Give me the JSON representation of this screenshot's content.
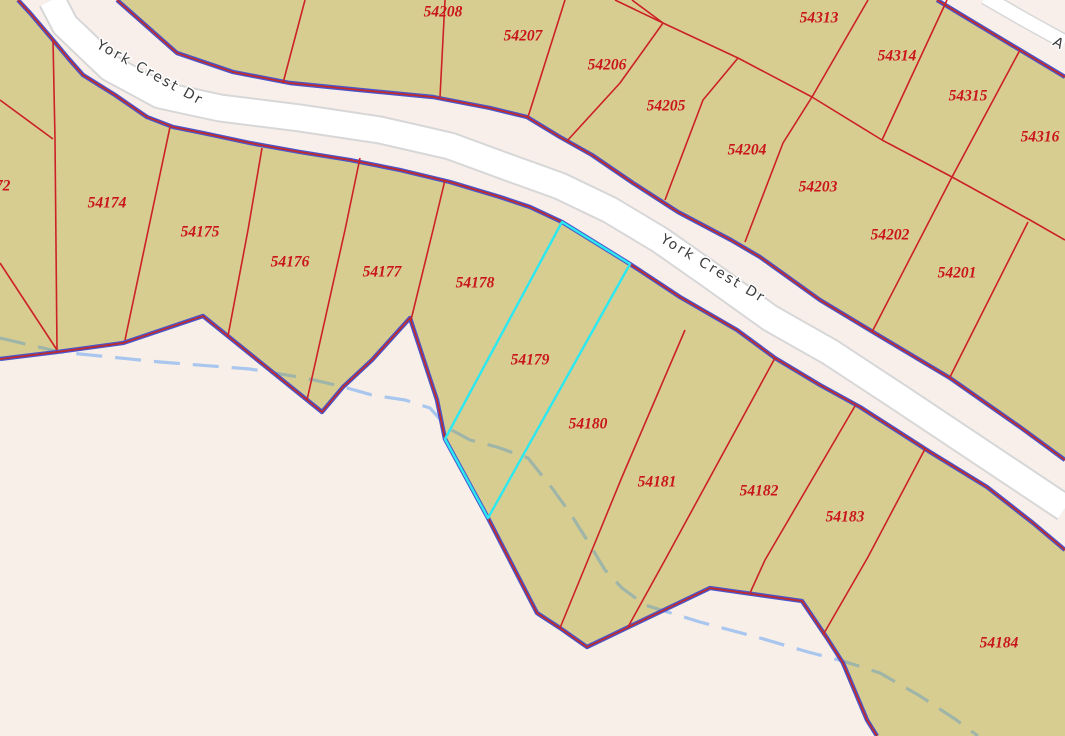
{
  "app": {
    "title": "Parcel map viewer - York Crest Dr subdivision"
  },
  "colors": {
    "background_pink": "#f8efe9",
    "parcel_tan": "#d8cd90",
    "parcel_line_red": "#cc2127",
    "parcel_label_red": "#c9151c",
    "boundary_blue": "#4a55cb",
    "boundary_red": "#c22a2a",
    "road_fill": "#f8efeb",
    "pavement_white": "#ffffff",
    "pavement_casing": "#d7d7d7",
    "selected_cyan": "#2ce8f0",
    "stream_blue": "#a8c6ee",
    "stream_under_tan": "#9fb5a8",
    "road_label_gray": "#3b3b3b"
  },
  "road_labels": [
    {
      "text": "York Crest Dr",
      "x": 150,
      "y": 73,
      "angle": 29
    },
    {
      "text": "York Crest Dr",
      "x": 713,
      "y": 269,
      "angle": 31
    },
    {
      "text": "A",
      "x": 1059,
      "y": 44,
      "angle": 30
    }
  ],
  "selected_parcel": "54179",
  "parcels": [
    {
      "id": "54172",
      "x": -9,
      "y": 187
    },
    {
      "id": "54174",
      "x": 107,
      "y": 204
    },
    {
      "id": "54175",
      "x": 200,
      "y": 233
    },
    {
      "id": "54176",
      "x": 290,
      "y": 263
    },
    {
      "id": "54177",
      "x": 382,
      "y": 273
    },
    {
      "id": "54178",
      "x": 475,
      "y": 284
    },
    {
      "id": "54179",
      "x": 530,
      "y": 361
    },
    {
      "id": "54180",
      "x": 588,
      "y": 425
    },
    {
      "id": "54181",
      "x": 657,
      "y": 483
    },
    {
      "id": "54182",
      "x": 759,
      "y": 492
    },
    {
      "id": "54183",
      "x": 845,
      "y": 518
    },
    {
      "id": "54184",
      "x": 999,
      "y": 644
    },
    {
      "id": "54201",
      "x": 957,
      "y": 274
    },
    {
      "id": "54202",
      "x": 890,
      "y": 236
    },
    {
      "id": "54203",
      "x": 818,
      "y": 188
    },
    {
      "id": "54204",
      "x": 747,
      "y": 151
    },
    {
      "id": "54205",
      "x": 666,
      "y": 107
    },
    {
      "id": "54206",
      "x": 607,
      "y": 66
    },
    {
      "id": "54207",
      "x": 523,
      "y": 37
    },
    {
      "id": "54208",
      "x": 443,
      "y": 13
    },
    {
      "id": "54209",
      "x": 352,
      "y": -4
    },
    {
      "id": "54313",
      "x": 819,
      "y": 19
    },
    {
      "id": "54314",
      "x": 897,
      "y": 57
    },
    {
      "id": "54315",
      "x": 968,
      "y": 97
    },
    {
      "id": "54316",
      "x": 1040,
      "y": 138
    }
  ],
  "geometry": {
    "road1_north_edge": [
      [
        117,
        0
      ],
      [
        177,
        53
      ],
      [
        233,
        72
      ],
      [
        290,
        83
      ],
      [
        360,
        90
      ],
      [
        433,
        97
      ],
      [
        490,
        108
      ],
      [
        527,
        117
      ],
      [
        560,
        137
      ],
      [
        592,
        155
      ],
      [
        633,
        183
      ],
      [
        678,
        212
      ],
      [
        731,
        240
      ],
      [
        760,
        257
      ],
      [
        820,
        300
      ],
      [
        873,
        332
      ],
      [
        950,
        378
      ],
      [
        1020,
        427
      ],
      [
        1065,
        460
      ]
    ],
    "road1_south_edge": [
      [
        18,
        0
      ],
      [
        30,
        13
      ],
      [
        53,
        40
      ],
      [
        68,
        58
      ],
      [
        83,
        75
      ],
      [
        115,
        95
      ],
      [
        147,
        117
      ],
      [
        173,
        127
      ],
      [
        203,
        133
      ],
      [
        250,
        143
      ],
      [
        300,
        152
      ],
      [
        350,
        160
      ],
      [
        400,
        170
      ],
      [
        450,
        182
      ],
      [
        500,
        197
      ],
      [
        530,
        207
      ],
      [
        562,
        222
      ],
      [
        630,
        264
      ],
      [
        680,
        297
      ],
      [
        737,
        330
      ],
      [
        775,
        358
      ],
      [
        820,
        385
      ],
      [
        860,
        407
      ],
      [
        930,
        452
      ],
      [
        987,
        487
      ],
      [
        1033,
        523
      ],
      [
        1065,
        550
      ]
    ],
    "road1_pavement": [
      [
        52,
        0
      ],
      [
        65,
        25
      ],
      [
        110,
        68
      ],
      [
        160,
        95
      ],
      [
        220,
        108
      ],
      [
        300,
        118
      ],
      [
        380,
        130
      ],
      [
        450,
        146
      ],
      [
        510,
        168
      ],
      [
        560,
        186
      ],
      [
        610,
        210
      ],
      [
        660,
        240
      ],
      [
        710,
        275
      ],
      [
        770,
        318
      ],
      [
        830,
        352
      ],
      [
        900,
        398
      ],
      [
        960,
        438
      ],
      [
        1020,
        478
      ],
      [
        1065,
        508
      ]
    ],
    "road2_polygon": [
      [
        937,
        0
      ],
      [
        1065,
        77
      ],
      [
        1065,
        0
      ]
    ],
    "road2_edge": [
      [
        937,
        0
      ],
      [
        990,
        32
      ],
      [
        1065,
        77
      ]
    ],
    "road2_pavement": [
      [
        985,
        -3
      ],
      [
        1025,
        20
      ],
      [
        1065,
        42
      ]
    ],
    "zigzag_boundary": [
      [
        0,
        359
      ],
      [
        57,
        352
      ],
      [
        123,
        343
      ],
      [
        203,
        316
      ],
      [
        322,
        412
      ],
      [
        343,
        387
      ],
      [
        372,
        360
      ],
      [
        410,
        318
      ],
      [
        437,
        400
      ],
      [
        445,
        439
      ],
      [
        488,
        518
      ],
      [
        537,
        613
      ],
      [
        560,
        628
      ],
      [
        587,
        647
      ],
      [
        710,
        588
      ],
      [
        802,
        601
      ],
      [
        827,
        638
      ],
      [
        843,
        663
      ],
      [
        867,
        720
      ],
      [
        877,
        736
      ]
    ],
    "tan_south_extra": [
      [
        0,
        0
      ],
      [
        18,
        0
      ]
    ],
    "tan_south_close": [
      [
        1065,
        736
      ],
      [
        877,
        736
      ]
    ],
    "tan_north": [
      [
        117,
        0
      ],
      [
        937,
        0
      ],
      [
        1065,
        77
      ],
      [
        1065,
        460
      ]
    ],
    "selected_outline": [
      [
        562,
        222
      ],
      [
        630,
        264
      ],
      [
        488,
        518
      ],
      [
        445,
        439
      ]
    ],
    "stream": [
      [
        0,
        338
      ],
      [
        60,
        352
      ],
      [
        160,
        362
      ],
      [
        250,
        369
      ],
      [
        305,
        378
      ],
      [
        340,
        386
      ],
      [
        372,
        395
      ],
      [
        405,
        400
      ],
      [
        430,
        408
      ],
      [
        448,
        428
      ],
      [
        470,
        440
      ],
      [
        497,
        447
      ],
      [
        528,
        458
      ],
      [
        552,
        488
      ],
      [
        570,
        513
      ],
      [
        587,
        540
      ],
      [
        605,
        570
      ],
      [
        622,
        588
      ],
      [
        645,
        605
      ],
      [
        700,
        622
      ],
      [
        760,
        638
      ],
      [
        808,
        652
      ],
      [
        843,
        661
      ],
      [
        880,
        673
      ],
      [
        920,
        696
      ],
      [
        955,
        719
      ],
      [
        978,
        736
      ]
    ],
    "red_lines": [
      [
        [
          53,
          40
        ],
        [
          55,
          139
        ],
        [
          57,
          350
        ]
      ],
      [
        [
          0,
          100
        ],
        [
          53,
          139
        ]
      ],
      [
        [
          0,
          263
        ],
        [
          57,
          350
        ]
      ],
      [
        [
          170,
          127
        ],
        [
          125,
          340
        ]
      ],
      [
        [
          262,
          148
        ],
        [
          248,
          230
        ],
        [
          228,
          336
        ]
      ],
      [
        [
          360,
          158
        ],
        [
          345,
          230
        ],
        [
          307,
          400
        ]
      ],
      [
        [
          445,
          180
        ],
        [
          433,
          230
        ],
        [
          411,
          320
        ]
      ],
      [
        [
          685,
          330
        ],
        [
          622,
          477
        ],
        [
          560,
          628
        ]
      ],
      [
        [
          775,
          358
        ],
        [
          665,
          560
        ],
        [
          628,
          627
        ]
      ],
      [
        [
          855,
          406
        ],
        [
          765,
          560
        ],
        [
          750,
          593
        ]
      ],
      [
        [
          925,
          449
        ],
        [
          868,
          557
        ],
        [
          823,
          635
        ]
      ],
      [
        [
          305,
          0
        ],
        [
          283,
          83
        ]
      ],
      [
        [
          445,
          0
        ],
        [
          440,
          97
        ]
      ],
      [
        [
          565,
          0
        ],
        [
          528,
          117
        ]
      ],
      [
        [
          663,
          23
        ],
        [
          620,
          83
        ],
        [
          567,
          141
        ]
      ],
      [
        [
          738,
          58
        ],
        [
          703,
          100
        ],
        [
          665,
          200
        ]
      ],
      [
        [
          812,
          97
        ],
        [
          783,
          143
        ],
        [
          745,
          242
        ]
      ],
      [
        [
          952,
          177
        ],
        [
          872,
          332
        ]
      ],
      [
        [
          1028,
          222
        ],
        [
          950,
          377
        ]
      ],
      [
        [
          615,
          0
        ],
        [
          663,
          23
        ],
        [
          738,
          58
        ],
        [
          812,
          97
        ],
        [
          882,
          140
        ],
        [
          952,
          177
        ],
        [
          1030,
          220
        ],
        [
          1065,
          240
        ]
      ],
      [
        [
          632,
          0
        ],
        [
          663,
          23
        ]
      ],
      [
        [
          868,
          0
        ],
        [
          812,
          97
        ]
      ],
      [
        [
          947,
          0
        ],
        [
          882,
          140
        ]
      ],
      [
        [
          1020,
          50
        ],
        [
          952,
          177
        ]
      ]
    ]
  }
}
